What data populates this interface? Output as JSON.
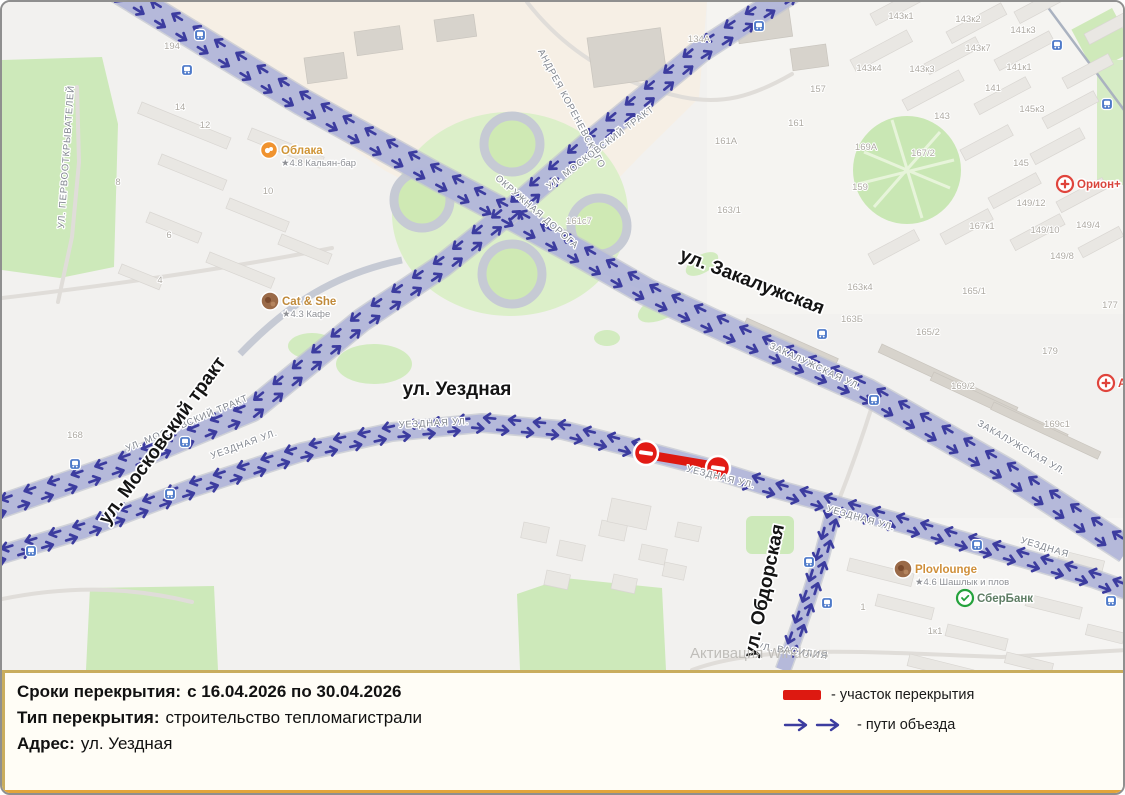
{
  "panel": {
    "rows": [
      {
        "label": "Сроки перекрытия:",
        "value": "с 16.04.2026 по 30.04.2026"
      },
      {
        "label": "Тип перекрытия:",
        "value": "строительство тепломагистрали"
      },
      {
        "label": "Адрес:",
        "value": "ул. Уездная"
      }
    ],
    "legend": [
      {
        "icon": "closure-bar",
        "label": "- участок перекрытия"
      },
      {
        "icon": "detour-arrows",
        "label": "- пути объезда"
      }
    ]
  },
  "map": {
    "watermark": {
      "text": "Активация Windows",
      "x": 688,
      "y": 656
    },
    "colors": {
      "detour_route": "#b2b6da",
      "detour_arrow": "#3c3c9f",
      "closure": "#de1810",
      "transit_stop": "#4d79c9"
    },
    "major_street_labels": [
      {
        "text": "ул. Московский тракт",
        "x": 165,
        "y": 442,
        "rot": -54
      },
      {
        "text": "ул. Закалужская",
        "x": 748,
        "y": 285,
        "rot": 21
      },
      {
        "text": "ул. Уездная",
        "x": 455,
        "y": 393,
        "rot": 0
      },
      {
        "text": "ул. Обдорская",
        "x": 768,
        "y": 590,
        "rot": -78
      }
    ],
    "minor_street_labels": [
      {
        "text": "ул. Первооткрывателей",
        "x": 67,
        "y": 155,
        "rot": -86
      },
      {
        "text": "Андрея Кореневского",
        "x": 567,
        "y": 108,
        "rot": 62
      },
      {
        "text": "ул. Московский тракт",
        "x": 186,
        "y": 424,
        "rot": -23
      },
      {
        "text": "ул. Московский тракт",
        "x": 600,
        "y": 148,
        "rot": -37
      },
      {
        "text": "Окружная дорога",
        "x": 533,
        "y": 212,
        "rot": 41
      },
      {
        "text": "Закалужская ул.",
        "x": 812,
        "y": 367,
        "rot": 25
      },
      {
        "text": "Закалужская ул.",
        "x": 1018,
        "y": 448,
        "rot": 30
      },
      {
        "text": "Уездная ул.",
        "x": 243,
        "y": 445,
        "rot": -20
      },
      {
        "text": "Уездная ул.",
        "x": 432,
        "y": 424,
        "rot": -3
      },
      {
        "text": "Уездная ул.",
        "x": 718,
        "y": 478,
        "rot": 14
      },
      {
        "text": "Уездная ул.",
        "x": 858,
        "y": 519,
        "rot": 16
      },
      {
        "text": "Уездная",
        "x": 1042,
        "y": 548,
        "rot": 17
      },
      {
        "text": "ул. Василия",
        "x": 790,
        "y": 652,
        "rot": 8
      }
    ],
    "house_numbers": [
      {
        "t": "194",
        "x": 170,
        "y": 47
      },
      {
        "t": "14",
        "x": 178,
        "y": 108
      },
      {
        "t": "12",
        "x": 203,
        "y": 126
      },
      {
        "t": "8",
        "x": 116,
        "y": 183
      },
      {
        "t": "10",
        "x": 266,
        "y": 192
      },
      {
        "t": "6",
        "x": 167,
        "y": 236
      },
      {
        "t": "4",
        "x": 158,
        "y": 281
      },
      {
        "t": "168",
        "x": 73,
        "y": 436
      },
      {
        "t": "134А",
        "x": 697,
        "y": 40
      },
      {
        "t": "161с7",
        "x": 577,
        "y": 222
      },
      {
        "t": "157",
        "x": 816,
        "y": 90
      },
      {
        "t": "161",
        "x": 794,
        "y": 124
      },
      {
        "t": "161А",
        "x": 724,
        "y": 142
      },
      {
        "t": "163/1",
        "x": 727,
        "y": 211
      },
      {
        "t": "169А",
        "x": 864,
        "y": 148
      },
      {
        "t": "159",
        "x": 858,
        "y": 188
      },
      {
        "t": "167/2",
        "x": 921,
        "y": 154
      },
      {
        "t": "143к1",
        "x": 899,
        "y": 17
      },
      {
        "t": "143к2",
        "x": 966,
        "y": 20
      },
      {
        "t": "141к3",
        "x": 1021,
        "y": 31
      },
      {
        "t": "143к7",
        "x": 976,
        "y": 49
      },
      {
        "t": "143к4",
        "x": 867,
        "y": 69
      },
      {
        "t": "143к3",
        "x": 920,
        "y": 70
      },
      {
        "t": "141к1",
        "x": 1017,
        "y": 68
      },
      {
        "t": "141",
        "x": 991,
        "y": 89
      },
      {
        "t": "143",
        "x": 940,
        "y": 117
      },
      {
        "t": "145к3",
        "x": 1030,
        "y": 110
      },
      {
        "t": "145",
        "x": 1019,
        "y": 164
      },
      {
        "t": "149/12",
        "x": 1029,
        "y": 204
      },
      {
        "t": "149/10",
        "x": 1043,
        "y": 231
      },
      {
        "t": "149/4",
        "x": 1086,
        "y": 226
      },
      {
        "t": "149/8",
        "x": 1060,
        "y": 257
      },
      {
        "t": "167к1",
        "x": 980,
        "y": 227
      },
      {
        "t": "163к4",
        "x": 858,
        "y": 288
      },
      {
        "t": "165/1",
        "x": 972,
        "y": 292
      },
      {
        "t": "163Б",
        "x": 850,
        "y": 320
      },
      {
        "t": "165/2",
        "x": 926,
        "y": 333
      },
      {
        "t": "179",
        "x": 1048,
        "y": 352
      },
      {
        "t": "169/2",
        "x": 961,
        "y": 387
      },
      {
        "t": "169с1",
        "x": 1055,
        "y": 425
      },
      {
        "t": "177",
        "x": 1108,
        "y": 306
      },
      {
        "t": "1",
        "x": 861,
        "y": 608
      },
      {
        "t": "1к1",
        "x": 933,
        "y": 632
      }
    ],
    "pois": [
      {
        "name": "Облака",
        "subtitle": "★4.8 Кальян-бар",
        "x": 267,
        "y": 148,
        "icon": "hookah-orange",
        "color": "#cf9434"
      },
      {
        "name": "Cat & She",
        "subtitle": "★4.3 Кафе",
        "x": 268,
        "y": 299,
        "icon": "photo",
        "color": "#c08a3a"
      },
      {
        "name": "Plovlounge",
        "subtitle": "★4.6 Шашлык и плов",
        "x": 901,
        "y": 567,
        "icon": "photo",
        "color": "#cf8f3a"
      },
      {
        "name": "СберБанк",
        "subtitle": "",
        "x": 963,
        "y": 596,
        "icon": "sber-green",
        "color": "#5e7d64"
      },
      {
        "name": "Орион+",
        "subtitle": "",
        "x": 1063,
        "y": 182,
        "icon": "pharmacy-red",
        "color": "#d9453c"
      },
      {
        "name": "А",
        "subtitle": "",
        "x": 1104,
        "y": 381,
        "icon": "pharmacy-red",
        "color": "#d9453c"
      }
    ],
    "transit_stops": [
      [
        198,
        33
      ],
      [
        185,
        68
      ],
      [
        757,
        24
      ],
      [
        1055,
        43
      ],
      [
        1105,
        102
      ],
      [
        73,
        462
      ],
      [
        183,
        440
      ],
      [
        168,
        492
      ],
      [
        29,
        549
      ],
      [
        820,
        332
      ],
      [
        872,
        398
      ],
      [
        807,
        560
      ],
      [
        825,
        601
      ],
      [
        975,
        543
      ],
      [
        1109,
        599
      ]
    ]
  }
}
